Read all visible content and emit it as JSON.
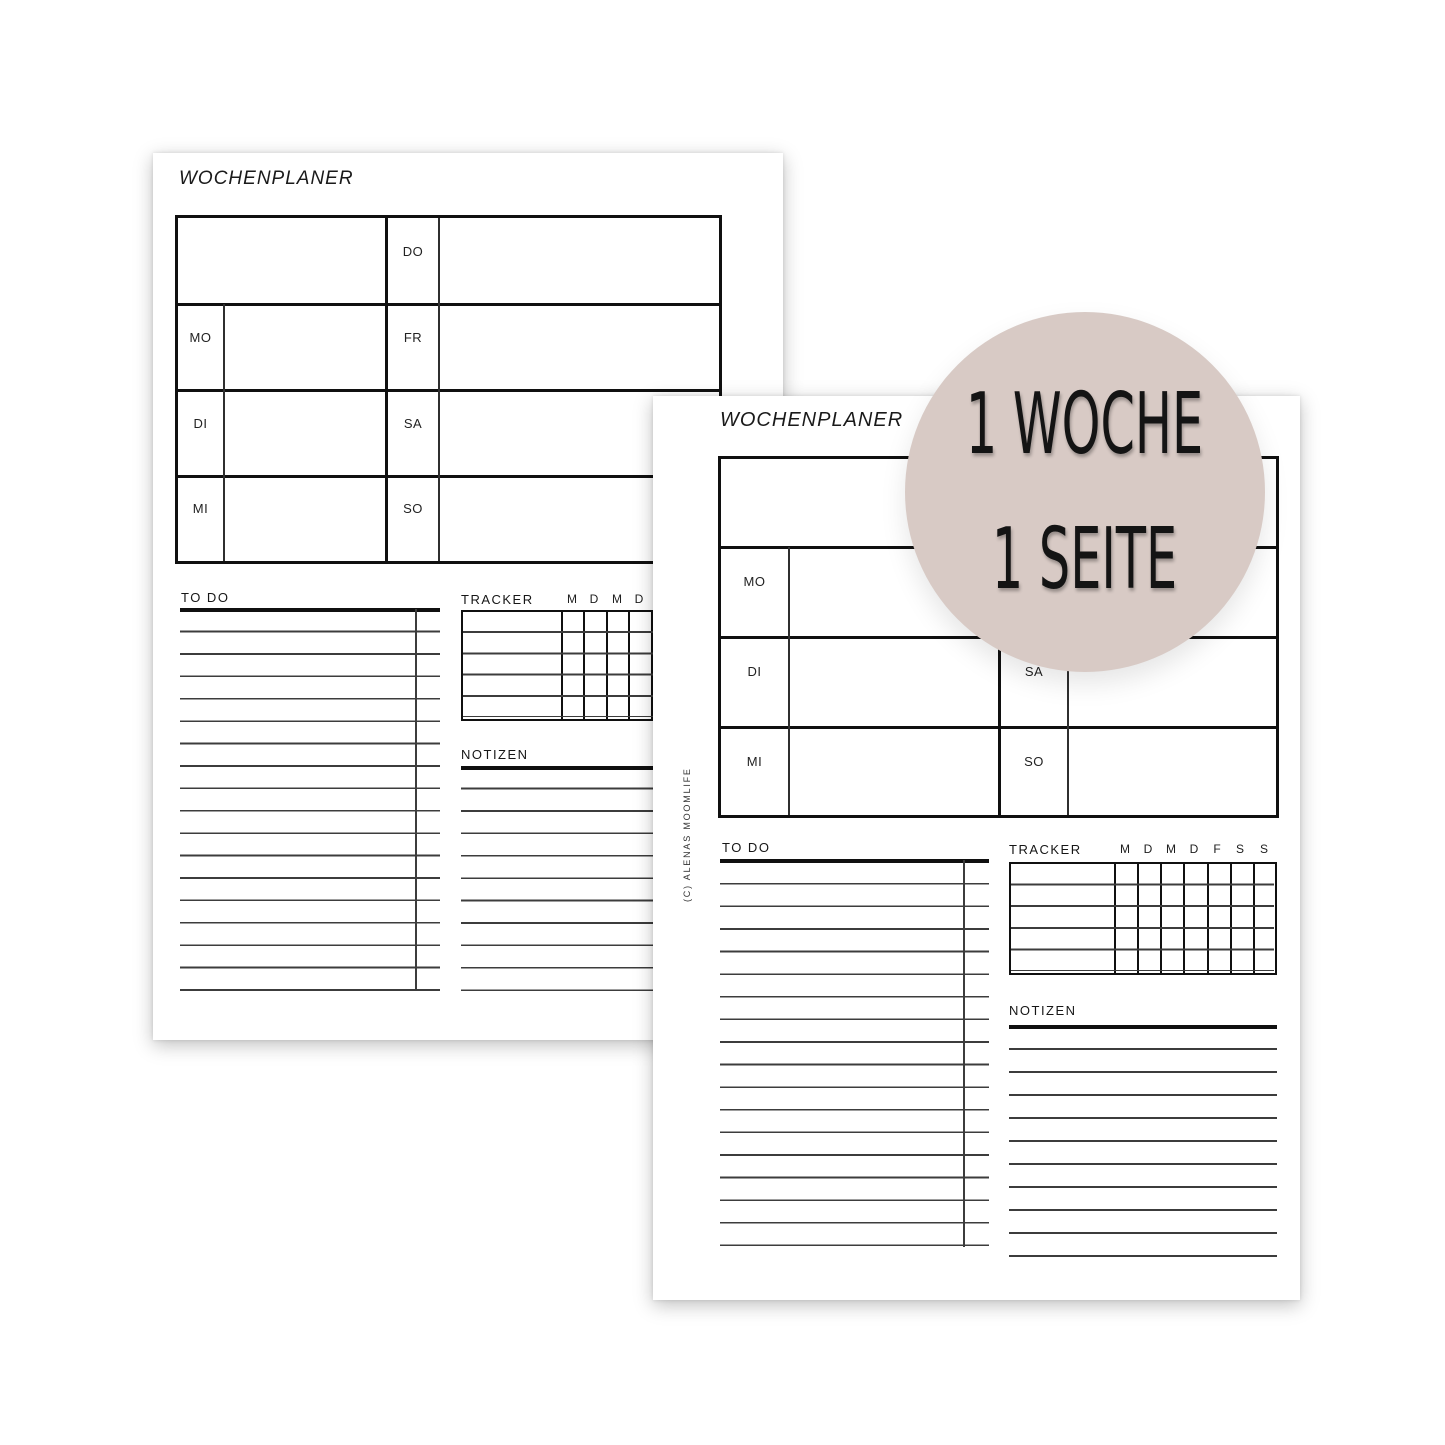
{
  "badge": {
    "text_line1": "1 WOCHE",
    "text_line2": "1 SEITE",
    "bg_color": "#d8cac5",
    "text_color": "#141414"
  },
  "back_page": {
    "title": "WOCHENPLANER",
    "week_grid": {
      "left_day_labels": [
        "MO",
        "DI",
        "MI"
      ],
      "right_day_labels": [
        "DO",
        "FR",
        "SA",
        "SO"
      ]
    },
    "todo": {
      "label": "TO DO"
    },
    "tracker": {
      "label": "TRACKER",
      "day_headers": [
        "M",
        "D",
        "M",
        "D",
        "F",
        "S",
        "S"
      ]
    },
    "notizen": {
      "label": "NOTIZEN"
    }
  },
  "front_page": {
    "title": "WOCHENPLANER",
    "copyright": "(C) ALENAS MOOMLIFE",
    "week_grid": {
      "left_day_labels": [
        "MO",
        "DI",
        "MI"
      ],
      "right_day_labels": [
        "DO",
        "FR",
        "SA",
        "SO"
      ]
    },
    "todo": {
      "label": "TO DO"
    },
    "tracker": {
      "label": "TRACKER",
      "day_headers": [
        "M",
        "D",
        "M",
        "D",
        "F",
        "S",
        "S"
      ]
    },
    "notizen": {
      "label": "NOTIZEN"
    }
  }
}
